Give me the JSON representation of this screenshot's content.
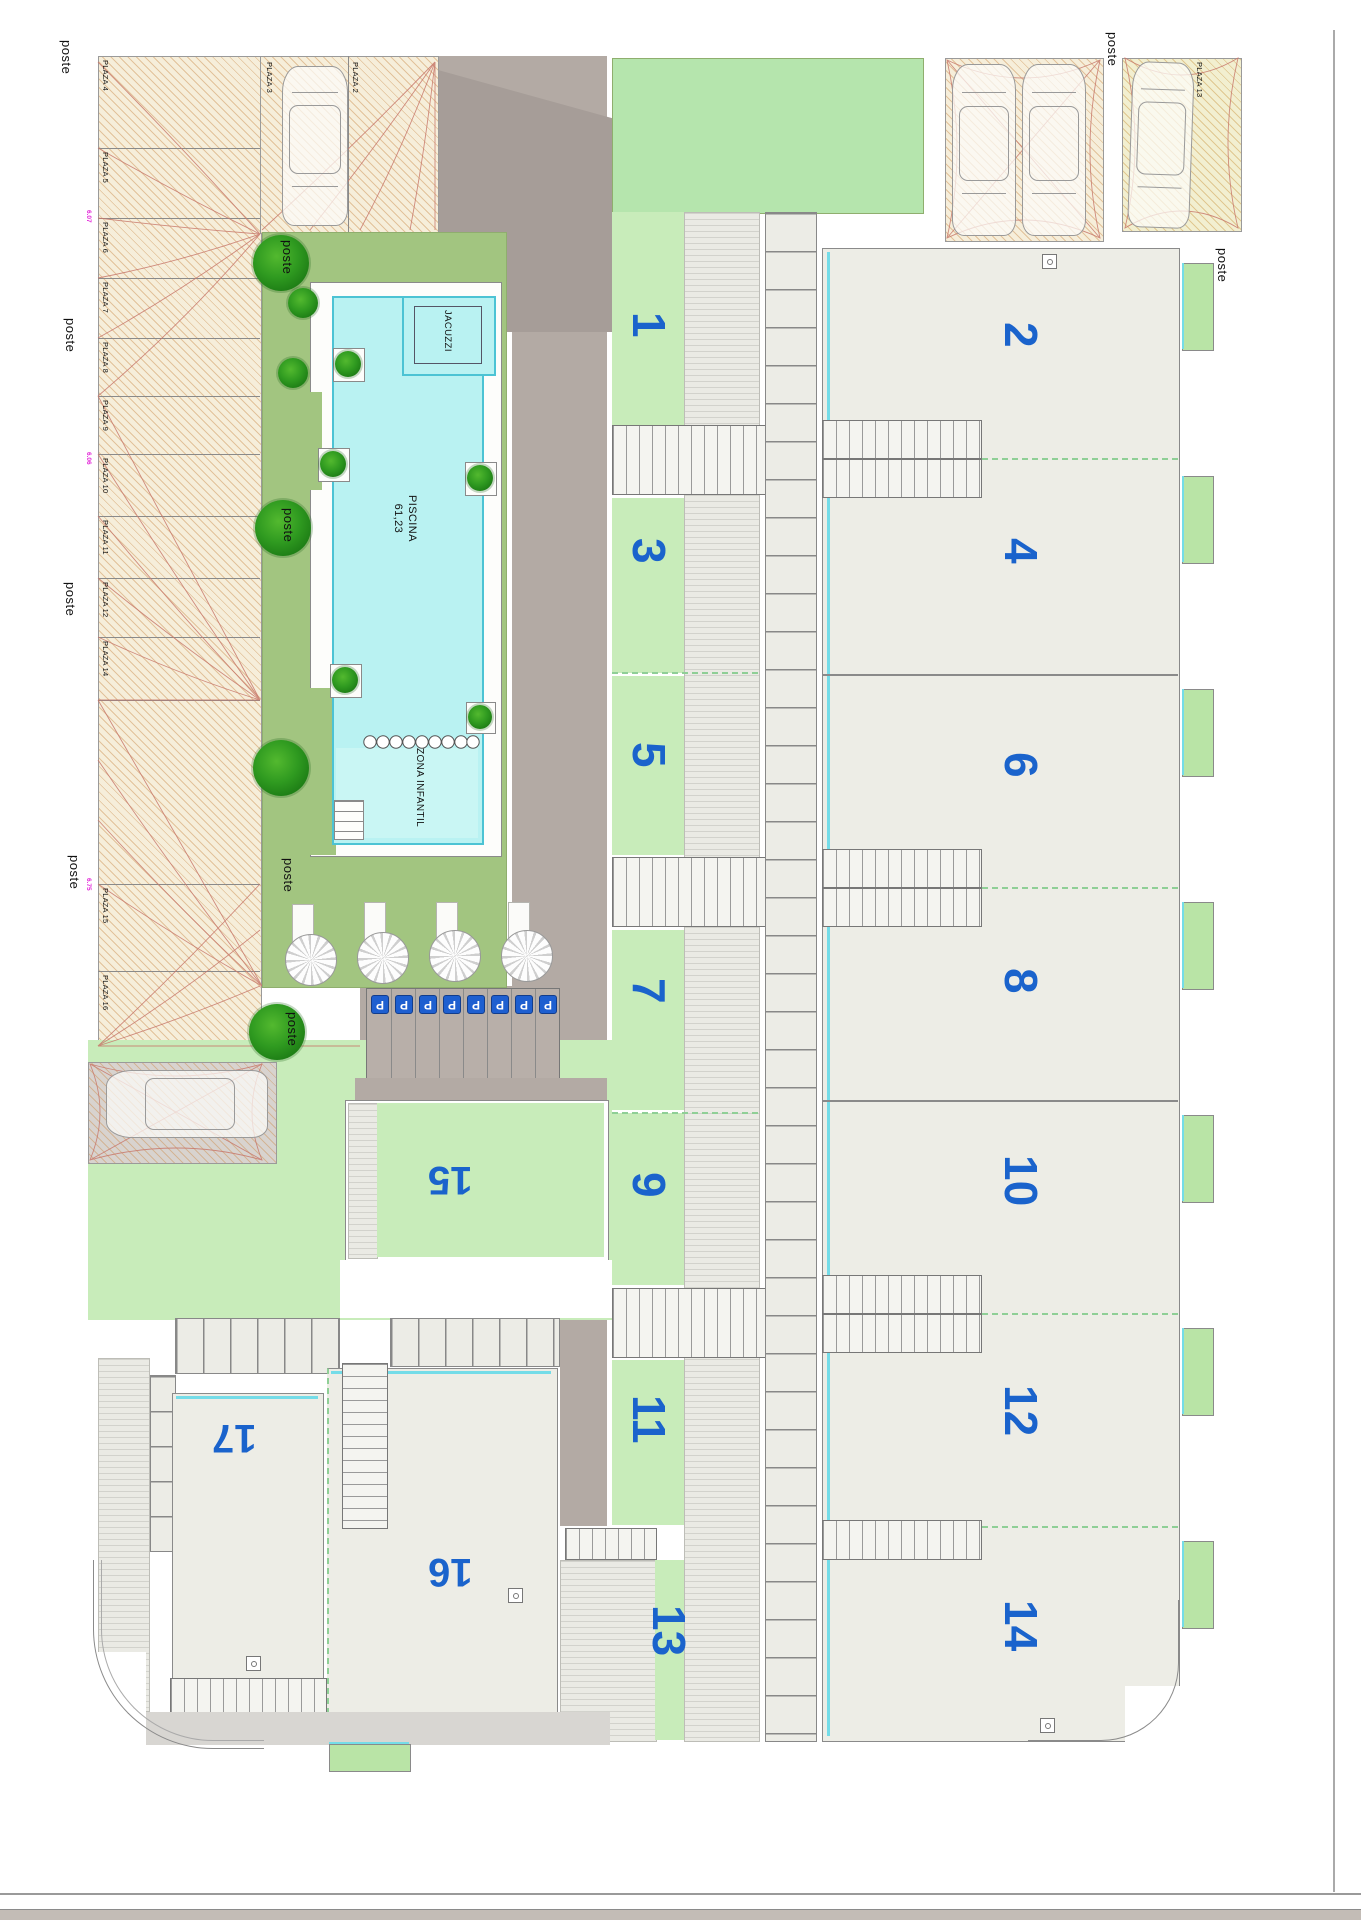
{
  "poste_label": "poste",
  "units": [
    "1",
    "2",
    "3",
    "4",
    "5",
    "6",
    "7",
    "8",
    "9",
    "10",
    "11",
    "12",
    "13",
    "14",
    "15",
    "16",
    "17"
  ],
  "plazas": [
    "PLAZA 2",
    "PLAZA 3",
    "PLAZA 4",
    "PLAZA 5",
    "PLAZA 6",
    "PLAZA 7",
    "PLAZA 8",
    "PLAZA 9",
    "PLAZA 10",
    "PLAZA 11",
    "PLAZA 12",
    "PLAZA 13",
    "PLAZA 14",
    "PLAZA 15",
    "PLAZA 16"
  ],
  "parking": {
    "sign": "P",
    "spots": [
      "P-16",
      "P-14",
      "P-12",
      "P-10",
      "P-8",
      "P-6",
      "P-4",
      "P-2"
    ]
  },
  "pool": {
    "name": "PISCINA",
    "area": "61,23",
    "jacuzzi": "JACUZZI",
    "kids_zone": "ZONA INFANTIL"
  },
  "dimensions": [
    "6.07",
    "6.06",
    "6.75"
  ]
}
